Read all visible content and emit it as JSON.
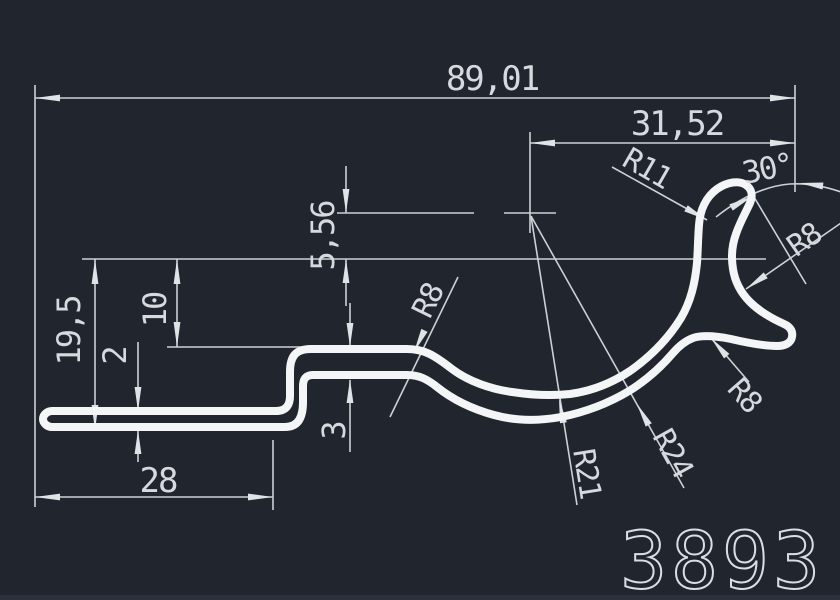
{
  "app": {
    "background": "#21252d",
    "profile_color": "#f3f5f6",
    "dimension_color": "#ccd1d5",
    "text_color": "#d6dade"
  },
  "title_block": {
    "number": "3893"
  },
  "dimensions": {
    "overall_width": "89,01",
    "hook_offset": "31,52",
    "tip_angle": "30°",
    "total_height": "19,5",
    "step_height": "10",
    "base_thickness": "2",
    "wall_thickness": "3",
    "base_length": "28",
    "center_offset": "5,56"
  },
  "radii": {
    "r11": "R11",
    "r8_hook": "R8",
    "r8_bend": "R8",
    "r8_under": "R8",
    "r21": "R21",
    "r24": "R24"
  }
}
